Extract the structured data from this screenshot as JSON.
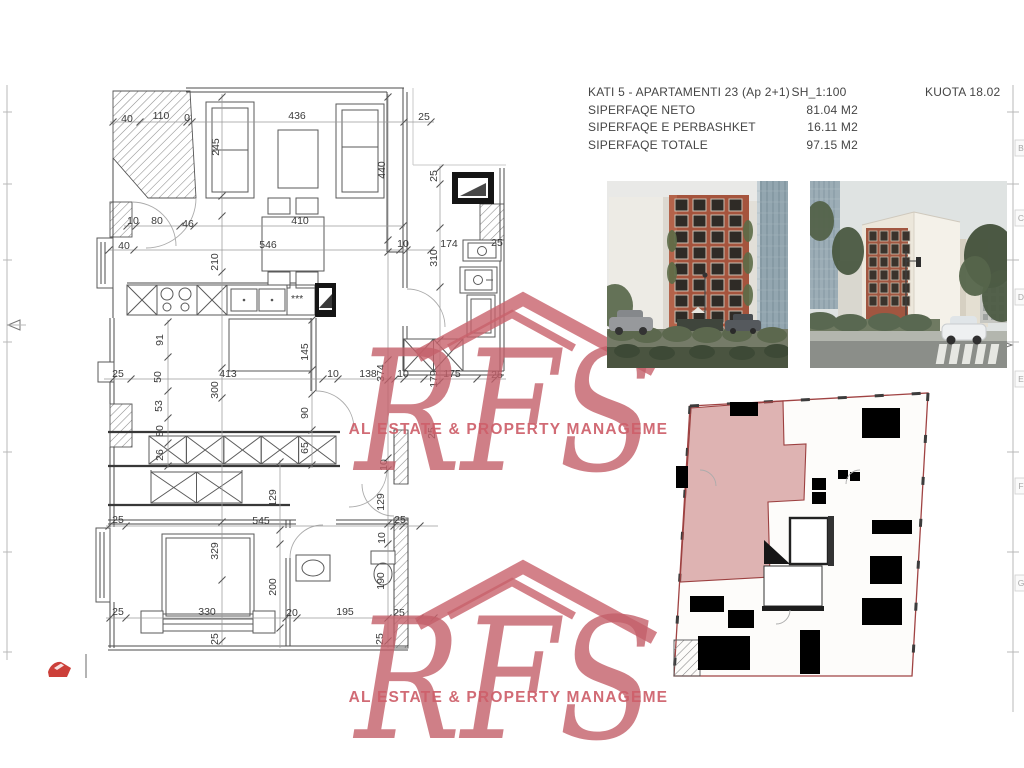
{
  "header": {
    "title": "KATI 5 - APARTAMENTI 23 (Ap 2+1)",
    "scale": "SH_1:100",
    "kuota": "KUOTA 18.02",
    "rows": [
      {
        "label": "SIPERFAQE NETO",
        "value": "81.04  M2"
      },
      {
        "label": "SIPERFAQE E PERBASHKET",
        "value": "16.11 M2"
      },
      {
        "label": "SIPERFAQE TOTALE",
        "value": "97.15 M2"
      }
    ]
  },
  "watermark": {
    "text": "RFS",
    "tagline": "REAL ESTATE & PROPERTY MANAGEMENT",
    "color": "#c75f68"
  },
  "sheet_grid": {
    "letters": [
      "B",
      "C",
      "D",
      "E",
      "F",
      "G"
    ],
    "ys": [
      148,
      218,
      297,
      379,
      486,
      583
    ]
  },
  "plan": {
    "stars": "***",
    "dimensions": [
      {
        "t": "40",
        "x": 127,
        "y": 122
      },
      {
        "t": "110",
        "x": 161,
        "y": 119
      },
      {
        "t": "0",
        "x": 187,
        "y": 121
      },
      {
        "t": "436",
        "x": 297,
        "y": 119
      },
      {
        "t": "25",
        "x": 424,
        "y": 120
      },
      {
        "t": "245",
        "x": 219,
        "y": 147,
        "v": 1
      },
      {
        "t": "440",
        "x": 385,
        "y": 170,
        "v": 1
      },
      {
        "t": "10",
        "x": 133,
        "y": 224
      },
      {
        "t": "80",
        "x": 157,
        "y": 224
      },
      {
        "t": "46",
        "x": 188,
        "y": 227
      },
      {
        "t": "410",
        "x": 300,
        "y": 224
      },
      {
        "t": "40",
        "x": 124,
        "y": 249
      },
      {
        "t": "546",
        "x": 268,
        "y": 248
      },
      {
        "t": "10",
        "x": 403,
        "y": 247
      },
      {
        "t": "174",
        "x": 449,
        "y": 247
      },
      {
        "t": "25",
        "x": 497,
        "y": 246
      },
      {
        "t": "210",
        "x": 218,
        "y": 262,
        "v": 1
      },
      {
        "t": "25",
        "x": 437,
        "y": 176,
        "v": 1
      },
      {
        "t": "310",
        "x": 437,
        "y": 258,
        "v": 1
      },
      {
        "t": "91",
        "x": 163,
        "y": 340,
        "v": 1
      },
      {
        "t": "50",
        "x": 161,
        "y": 377,
        "v": 1
      },
      {
        "t": "53",
        "x": 162,
        "y": 406,
        "v": 1
      },
      {
        "t": "80",
        "x": 163,
        "y": 431,
        "v": 1
      },
      {
        "t": "26",
        "x": 163,
        "y": 455,
        "v": 1
      },
      {
        "t": "25",
        "x": 118,
        "y": 377
      },
      {
        "t": "413",
        "x": 228,
        "y": 377
      },
      {
        "t": "300",
        "x": 218,
        "y": 390,
        "v": 1
      },
      {
        "t": "145",
        "x": 308,
        "y": 352,
        "v": 1
      },
      {
        "t": "10",
        "x": 333,
        "y": 377
      },
      {
        "t": "138",
        "x": 368,
        "y": 377
      },
      {
        "t": "374",
        "x": 384,
        "y": 373,
        "v": 1
      },
      {
        "t": "10",
        "x": 403,
        "y": 377
      },
      {
        "t": "179",
        "x": 437,
        "y": 379,
        "v": 1
      },
      {
        "t": "175",
        "x": 452,
        "y": 377
      },
      {
        "t": "25",
        "x": 497,
        "y": 378
      },
      {
        "t": "90",
        "x": 308,
        "y": 413,
        "v": 1
      },
      {
        "t": "65",
        "x": 308,
        "y": 448,
        "v": 1
      },
      {
        "t": "10",
        "x": 387,
        "y": 465,
        "v": 1
      },
      {
        "t": "129",
        "x": 276,
        "y": 498,
        "v": 1
      },
      {
        "t": "129",
        "x": 384,
        "y": 502,
        "v": 1
      },
      {
        "t": "25",
        "x": 435,
        "y": 433,
        "v": 1
      },
      {
        "t": "25",
        "x": 118,
        "y": 523
      },
      {
        "t": "545",
        "x": 261,
        "y": 524
      },
      {
        "t": "25",
        "x": 400,
        "y": 523
      },
      {
        "t": "10",
        "x": 385,
        "y": 538,
        "v": 1
      },
      {
        "t": "329",
        "x": 218,
        "y": 551,
        "v": 1
      },
      {
        "t": "200",
        "x": 276,
        "y": 587,
        "v": 1
      },
      {
        "t": "190",
        "x": 384,
        "y": 581,
        "v": 1
      },
      {
        "t": "25",
        "x": 118,
        "y": 615
      },
      {
        "t": "330",
        "x": 207,
        "y": 615
      },
      {
        "t": "20",
        "x": 292,
        "y": 616
      },
      {
        "t": "195",
        "x": 345,
        "y": 615
      },
      {
        "t": "25",
        "x": 399,
        "y": 616
      },
      {
        "t": "25",
        "x": 218,
        "y": 639,
        "v": 1
      },
      {
        "t": "25",
        "x": 383,
        "y": 639,
        "v": 1
      }
    ]
  },
  "key_plan": {
    "highlight": "#b95c5c",
    "outline": "#a04343"
  }
}
